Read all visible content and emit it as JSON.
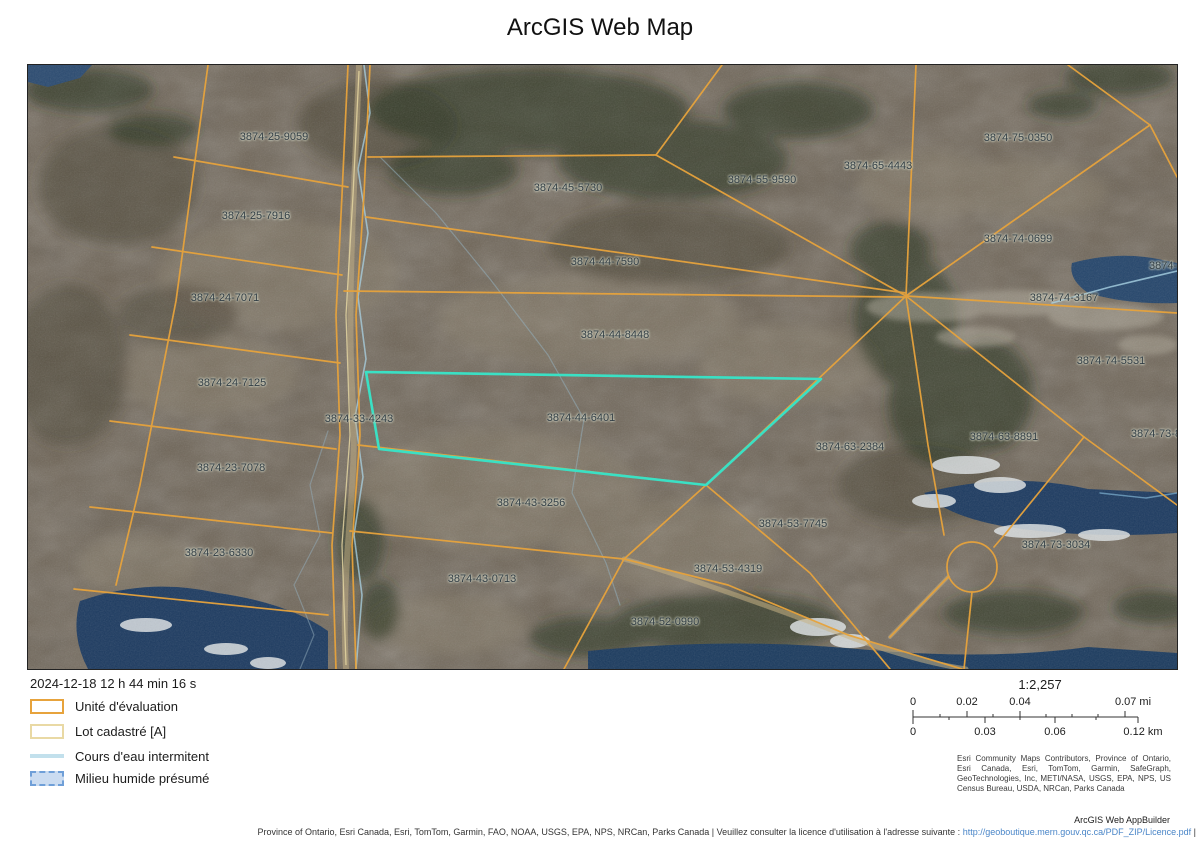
{
  "title": "ArcGIS Web Map",
  "map": {
    "parcels": [
      {
        "label": "3874-25-9059",
        "x": 246,
        "y": 72
      },
      {
        "label": "3874-45-5730",
        "x": 540,
        "y": 123
      },
      {
        "label": "3874-55-9590",
        "x": 734,
        "y": 115
      },
      {
        "label": "3874-65-4443",
        "x": 850,
        "y": 101
      },
      {
        "label": "3874-75-0350",
        "x": 990,
        "y": 73
      },
      {
        "label": "3874-25-7916",
        "x": 228,
        "y": 151
      },
      {
        "label": "3874-44-7590",
        "x": 577,
        "y": 197
      },
      {
        "label": "3874-74-0699",
        "x": 990,
        "y": 174
      },
      {
        "label": "3874-74-",
        "x": 1143,
        "y": 201
      },
      {
        "label": "3874-24-7071",
        "x": 197,
        "y": 233
      },
      {
        "label": "3874-74-3167",
        "x": 1036,
        "y": 233
      },
      {
        "label": "3874-44-8448",
        "x": 587,
        "y": 270
      },
      {
        "label": "3874-74-5531",
        "x": 1083,
        "y": 296
      },
      {
        "label": "3874-24-7125",
        "x": 204,
        "y": 318
      },
      {
        "label": "3874-33-4243",
        "x": 331,
        "y": 354
      },
      {
        "label": "3874-44-6401",
        "x": 553,
        "y": 353
      },
      {
        "label": "3874-63-2384",
        "x": 822,
        "y": 382
      },
      {
        "label": "3874-63-8891",
        "x": 976,
        "y": 372
      },
      {
        "label": "3874-73-8",
        "x": 1128,
        "y": 369
      },
      {
        "label": "3874-23-7078",
        "x": 203,
        "y": 403
      },
      {
        "label": "3874-43-3256",
        "x": 503,
        "y": 438
      },
      {
        "label": "3874-53-7745",
        "x": 765,
        "y": 459
      },
      {
        "label": "3874-73-3034",
        "x": 1028,
        "y": 480
      },
      {
        "label": "3874-23-6330",
        "x": 191,
        "y": 488
      },
      {
        "label": "3874-53-4319",
        "x": 700,
        "y": 504
      },
      {
        "label": "3874-43-0713",
        "x": 454,
        "y": 514
      },
      {
        "label": "3874-52-0990",
        "x": 637,
        "y": 557
      }
    ],
    "colors": {
      "highlight": "#3ae0c4",
      "parcel_line": "#e7a33c",
      "lot_line": "#e9d9a4",
      "water": "#1c3a60",
      "stream": "#a9d2e3"
    }
  },
  "footer": {
    "timestamp": "2024-12-18 12 h 44 min 16 s",
    "legend": [
      "Unité d'évaluation",
      "Lot cadastré [A]",
      "Cours d'eau intermitent",
      "Milieu humide présumé"
    ],
    "scale": {
      "ratio": "1:2,257",
      "mi": [
        "0",
        "0.02",
        "0.04",
        "0.07 mi"
      ],
      "km": [
        "0",
        "0.03",
        "0.06",
        "0.12 km"
      ]
    },
    "attribution": "Esri Community Maps Contributors, Province of Ontario, Esri Canada, Esri, TomTom, Garmin, SafeGraph, GeoTechnologies, Inc, METI/NASA, USGS, EPA, NPS, US Census Bureau, USDA, NRCan, Parks Canada",
    "app_credit": "ArcGIS Web AppBuilder",
    "license": {
      "prefix": "Province of Ontario, Esri Canada, Esri, TomTom, Garmin, FAO, NOAA, USGS, EPA, NPS, NRCan, Parks Canada | Veuillez consulter la licence d'utilisation à l'adresse suivante : ",
      "link": "http://geoboutique.mern.gouv.qc.ca/PDF_ZIP/Licence.pdf",
      "suffix": " |"
    }
  }
}
